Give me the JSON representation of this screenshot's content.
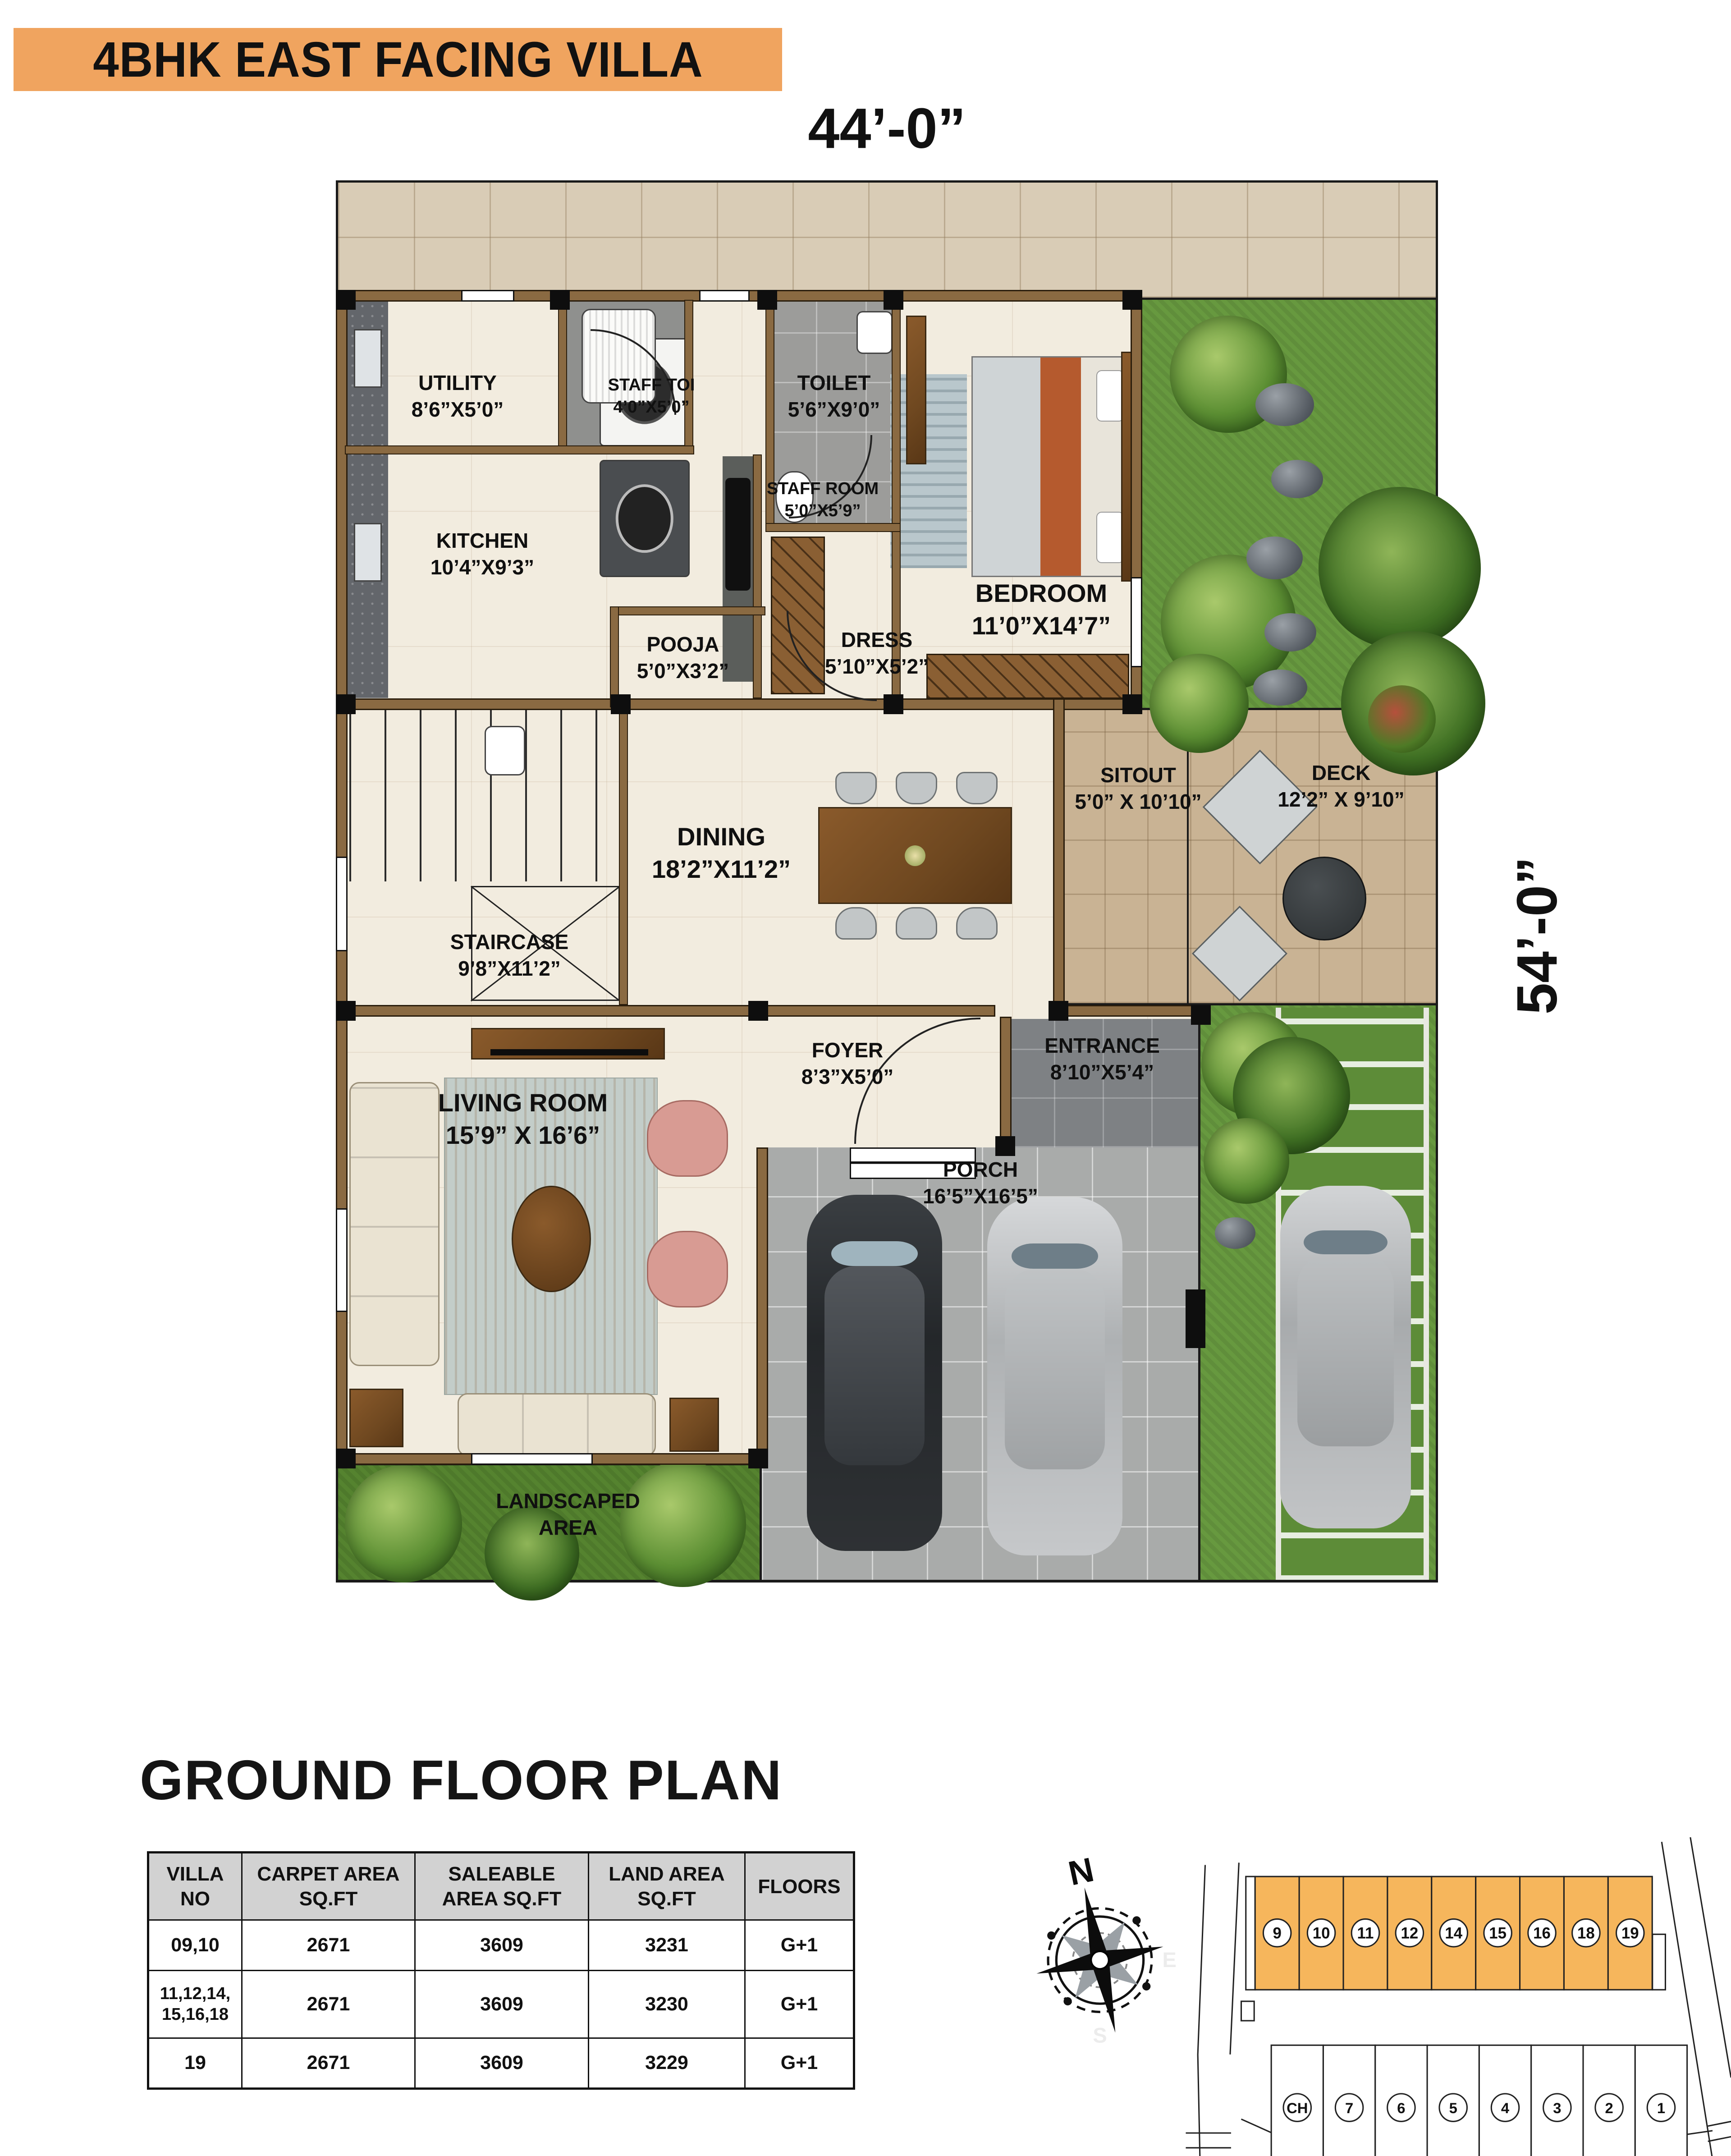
{
  "title": "4BHK EAST FACING VILLA",
  "dimensions": {
    "top": "44’-0”",
    "right": "54’-0”"
  },
  "plan": {
    "rooms": {
      "utility": {
        "name": "UTILITY",
        "dims": "8’6”X5’0”"
      },
      "staff_toi": {
        "name": "STAFF TOI",
        "dims": "4’0”X5’0”"
      },
      "toilet": {
        "name": "TOILET",
        "dims": "5’6”X9’0”"
      },
      "kitchen": {
        "name": "KITCHEN",
        "dims": "10’4”X9’3”"
      },
      "staff_room": {
        "name": "STAFF ROOM",
        "dims": "5’0”X5’9”"
      },
      "pooja": {
        "name": "POOJA",
        "dims": "5’0”X3’2”"
      },
      "dress": {
        "name": "DRESS",
        "dims": "5’10”X5’2”"
      },
      "bedroom": {
        "name": "BEDROOM",
        "dims": "11’0”X14’7”"
      },
      "dining": {
        "name": "DINING",
        "dims": "18’2”X11’2”"
      },
      "sitout": {
        "name": "SITOUT",
        "dims": "5’0” X 10’10”"
      },
      "deck": {
        "name": "DECK",
        "dims": "12’2” X 9’10”"
      },
      "staircase": {
        "name": "STAIRCASE",
        "dims": "9’8”X11’2”"
      },
      "foyer": {
        "name": "FOYER",
        "dims": "8’3”X5’0”"
      },
      "entrance": {
        "name": "ENTRANCE",
        "dims": "8’10”X5’4”"
      },
      "living": {
        "name": "LIVING ROOM",
        "dims": "15’9” X 16’6”"
      },
      "porch": {
        "name": "PORCH",
        "dims": "16’5”X16’5”"
      },
      "landscaped": {
        "name": "LANDSCAPED AREA",
        "dims": ""
      }
    }
  },
  "section_title": "GROUND FLOOR PLAN",
  "table": {
    "headers": [
      "VILLA NO",
      "CARPET AREA SQ.FT",
      "SALEABLE AREA SQ.FT",
      "LAND AREA SQ.FT",
      "FLOORS"
    ],
    "rows": [
      [
        "09,10",
        "2671",
        "3609",
        "3231",
        "G+1"
      ],
      [
        "11,12,14, 15,16,18",
        "2671",
        "3609",
        "3230",
        "G+1"
      ],
      [
        "19",
        "2671",
        "3609",
        "3229",
        "G+1"
      ]
    ]
  },
  "compass": {
    "north": "N",
    "east": "E",
    "south": "S"
  },
  "site_plan": {
    "top_row": [
      "9",
      "10",
      "11",
      "12",
      "14",
      "15",
      "16",
      "18",
      "19"
    ],
    "bottom_row": [
      "CH",
      "7",
      "6",
      "5",
      "4",
      "3",
      "2",
      "1"
    ]
  },
  "colors": {
    "banner": "#F0A45F",
    "site_highlight": "#F6B65C",
    "wall": "#8A6A42",
    "grass": "#67993F",
    "patio_tile": "#D9CCB6",
    "deck": "#C9B394",
    "porch": "#A9ABAA",
    "entrance": "#7E8184",
    "floor": "#F2ECDF",
    "table_header": "#D2D2D2"
  }
}
